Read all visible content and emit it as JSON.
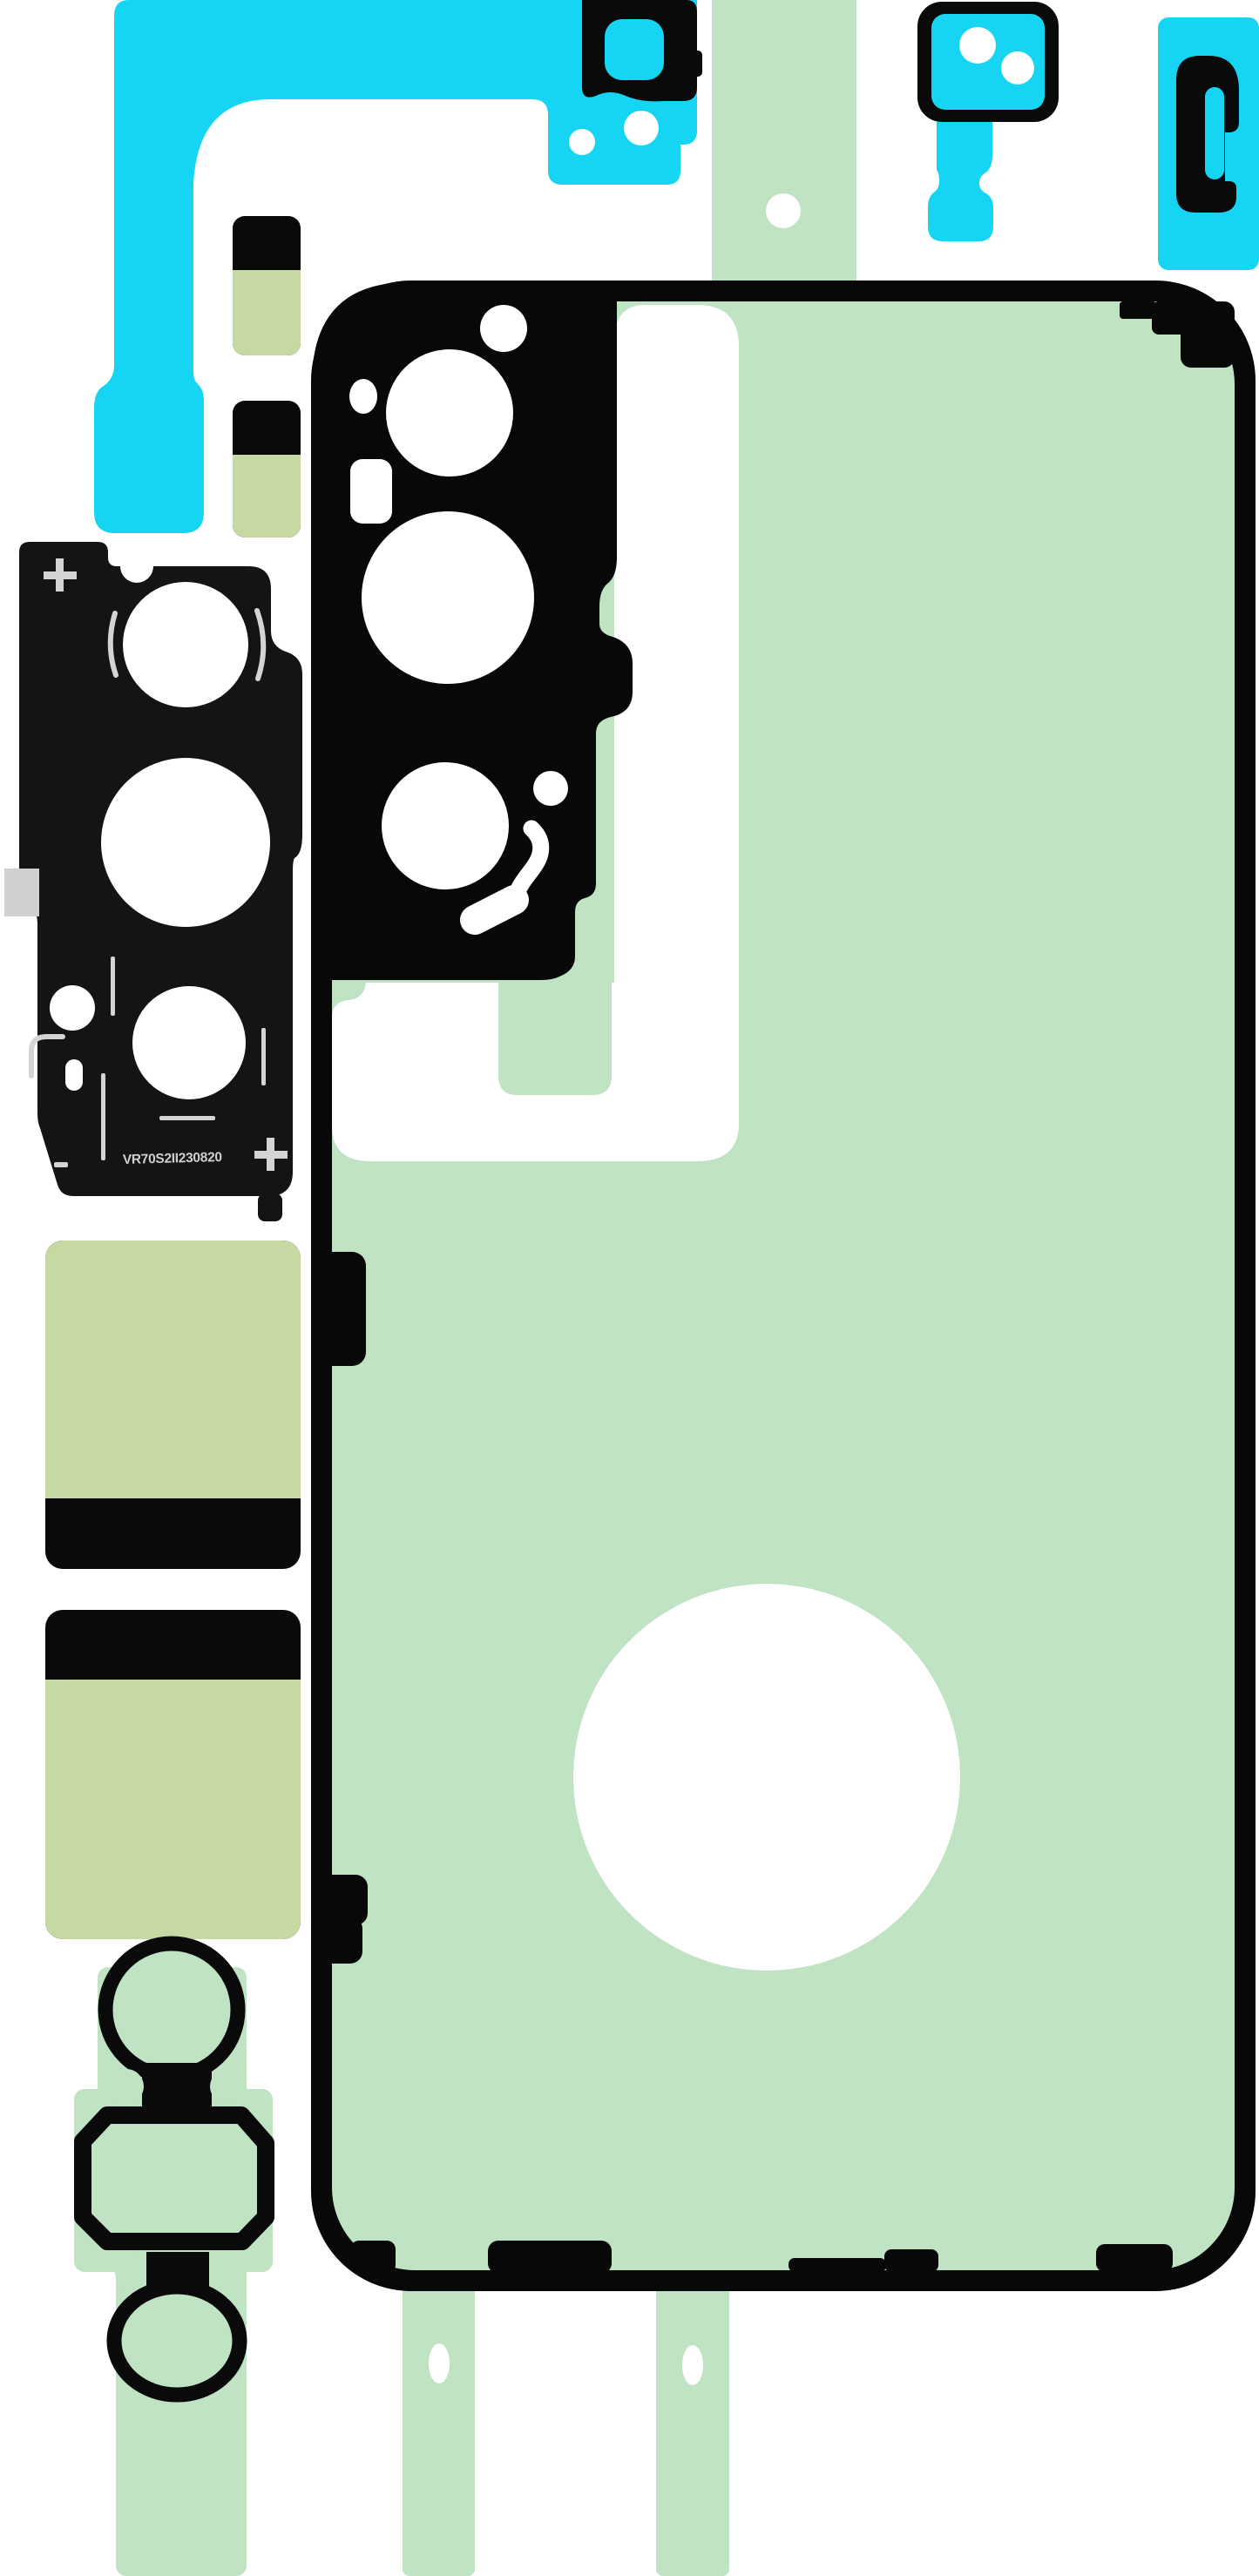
{
  "page": {
    "title": "Smartphone back-cover adhesive rework kit sheet",
    "background": "#ffffff"
  },
  "colors": {
    "cyan": "#16d5f2",
    "mint_green": "#c0e3c4",
    "olive_green": "#c6d9a3",
    "black": "#080808",
    "panel_black": "#141414",
    "marker_gray": "#d4d4d4",
    "white": "#ffffff"
  },
  "pieces": {
    "flex_cable_tape": {
      "name": "cyan flex-cable shaped adhesive with camera bracket"
    },
    "camera_frame_tape": {
      "name": "cyan key-shaped adhesive with black camera frame"
    },
    "pull_tab_tape": {
      "name": "cyan pull-tab adhesive with black hook"
    },
    "camera_lens_panel": {
      "serial": "VR70S2II230820",
      "plus_mark_top": "+",
      "plus_mark_bottom": "+",
      "minus_mark": "-",
      "name": "black camera lens adhesive panel"
    },
    "back_cover_adhesive": {
      "name": "mint green back cover gasket adhesive with camera cutout"
    },
    "spacer_tapes": {
      "name": "olive green and black spacer strips"
    },
    "gasket_chain": {
      "name": "black ring gasket chain on mint liner strip"
    },
    "liner_strips": {
      "name": "mint liner strips with alignment holes"
    }
  }
}
